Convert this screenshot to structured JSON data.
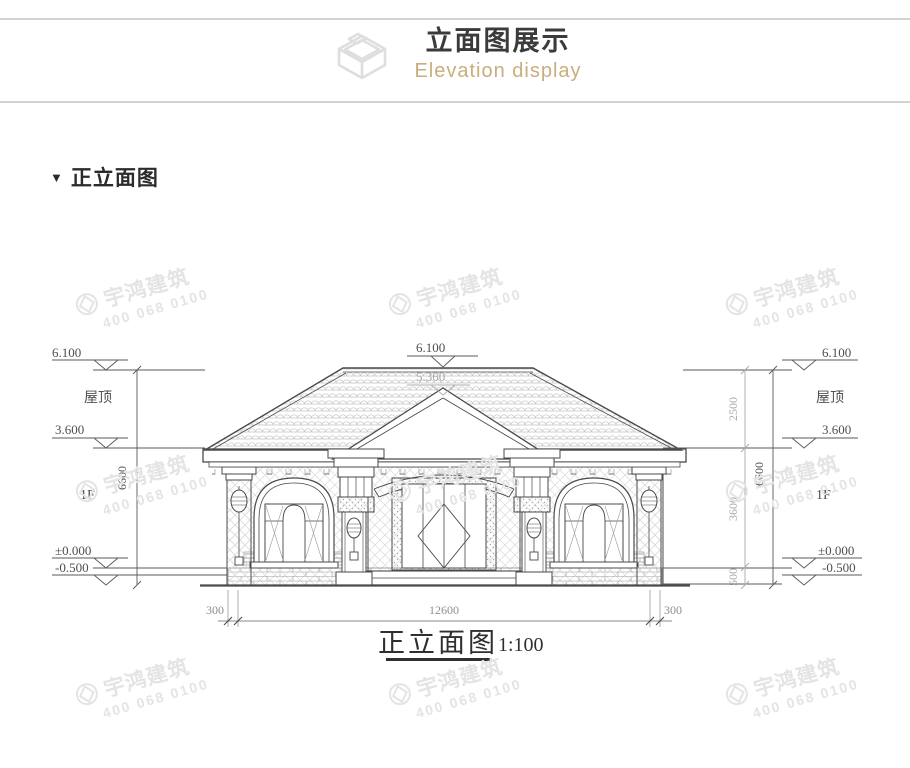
{
  "header": {
    "title": "立面图展示",
    "subtitle": "Elevation display"
  },
  "section": {
    "marker": "▼",
    "title": "正立面图"
  },
  "watermark": {
    "brand": "宇鸿建筑",
    "phone": "400 068 0100"
  },
  "drawing": {
    "caption": "正立面图",
    "scale": "1:100",
    "labels": {
      "roof": "屋顶",
      "floor": "1F"
    },
    "levels": {
      "ridge": "6.100",
      "gable": "5.360",
      "eave": "3.600",
      "zero": "±0.000",
      "ground": "-0.500"
    },
    "heights": {
      "total": "6600",
      "roof": "2500",
      "floor": "3600",
      "base": "500"
    },
    "widths": {
      "side": "300",
      "main": "12600"
    }
  },
  "colors": {
    "subtitle_accent": "#c8ae7d",
    "line": "#4a4a4a",
    "dim_gray": "#a8a8a8",
    "watermark": "#e4e4e4"
  }
}
